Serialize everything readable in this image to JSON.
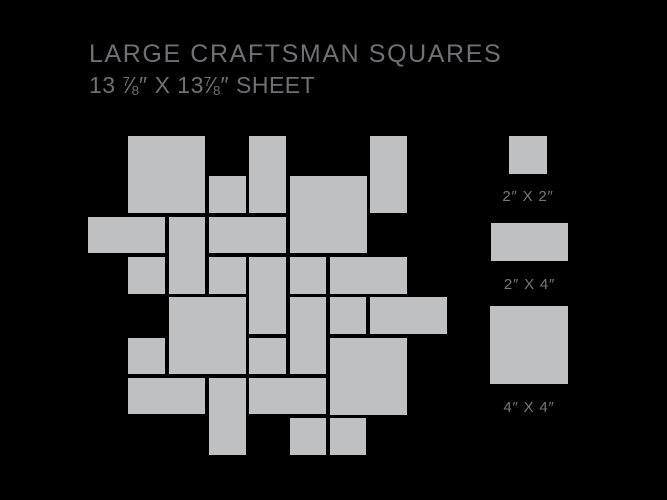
{
  "header": {
    "title": "LARGE CRAFTSMAN SQUARES",
    "subtitle": {
      "part1": "13 ",
      "frac_num": "7",
      "frac_slash": "⁄",
      "frac_den": "8",
      "part2": "″ X 13",
      "part3": "″ SHEET"
    }
  },
  "colors": {
    "background": "#000000",
    "tile": "#bec0c2",
    "title_text": "#6f7073",
    "label_text": "#75777a"
  },
  "pattern": {
    "description": "mosaic sheet layout of gray tiles on black, staggered edges",
    "origin_x": 88,
    "origin_y": 136,
    "unit_px": 40.3,
    "gap_px": 3.6,
    "tiles": [
      {
        "col": 1,
        "row": 0,
        "w": 2,
        "h": 2,
        "size": "4x4"
      },
      {
        "col": 4,
        "row": 0,
        "w": 1,
        "h": 2,
        "size": "2x4"
      },
      {
        "col": 7,
        "row": 0,
        "w": 1,
        "h": 2,
        "size": "2x4"
      },
      {
        "col": 3,
        "row": 1,
        "w": 1,
        "h": 1,
        "size": "2x2"
      },
      {
        "col": 5,
        "row": 1,
        "w": 2,
        "h": 2,
        "size": "4x4"
      },
      {
        "col": 0,
        "row": 2,
        "w": 2,
        "h": 1,
        "size": "2x4"
      },
      {
        "col": 2,
        "row": 2,
        "w": 1,
        "h": 2,
        "size": "2x4"
      },
      {
        "col": 3,
        "row": 2,
        "w": 2,
        "h": 1,
        "size": "2x4"
      },
      {
        "col": 1,
        "row": 3,
        "w": 1,
        "h": 1,
        "size": "2x2"
      },
      {
        "col": 3,
        "row": 3,
        "w": 1,
        "h": 1,
        "size": "2x2"
      },
      {
        "col": 4,
        "row": 3,
        "w": 1,
        "h": 2,
        "size": "2x4"
      },
      {
        "col": 5,
        "row": 3,
        "w": 1,
        "h": 1,
        "size": "2x2"
      },
      {
        "col": 6,
        "row": 3,
        "w": 2,
        "h": 1,
        "size": "2x4"
      },
      {
        "col": 2,
        "row": 4,
        "w": 2,
        "h": 2,
        "size": "4x4"
      },
      {
        "col": 5,
        "row": 4,
        "w": 1,
        "h": 2,
        "size": "2x4"
      },
      {
        "col": 6,
        "row": 4,
        "w": 1,
        "h": 1,
        "size": "2x2"
      },
      {
        "col": 7,
        "row": 4,
        "w": 2,
        "h": 1,
        "size": "2x4"
      },
      {
        "col": 1,
        "row": 5,
        "w": 1,
        "h": 1,
        "size": "2x2"
      },
      {
        "col": 4,
        "row": 5,
        "w": 1,
        "h": 1,
        "size": "2x2"
      },
      {
        "col": 6,
        "row": 5,
        "w": 2,
        "h": 2,
        "size": "4x4"
      },
      {
        "col": 1,
        "row": 6,
        "w": 2,
        "h": 1,
        "size": "2x4"
      },
      {
        "col": 3,
        "row": 6,
        "w": 1,
        "h": 2,
        "size": "2x4"
      },
      {
        "col": 4,
        "row": 6,
        "w": 2,
        "h": 1,
        "size": "2x4"
      },
      {
        "col": 5,
        "row": 7,
        "w": 1,
        "h": 1,
        "size": "2x2"
      },
      {
        "col": 6,
        "row": 7,
        "w": 1,
        "h": 1,
        "size": "2x2"
      }
    ]
  },
  "legend": {
    "items": [
      {
        "label": "2″ X 2″",
        "size": "2x2",
        "x": 509,
        "y": 136,
        "w": 38,
        "h": 38,
        "label_gap": 14
      },
      {
        "label": "2″ X 4″",
        "size": "2x4",
        "x": 491,
        "y": 223,
        "w": 77,
        "h": 38,
        "label_gap": 15
      },
      {
        "label": "4″ X 4″",
        "size": "4x4",
        "x": 490,
        "y": 306,
        "w": 78,
        "h": 78,
        "label_gap": 15
      }
    ]
  }
}
